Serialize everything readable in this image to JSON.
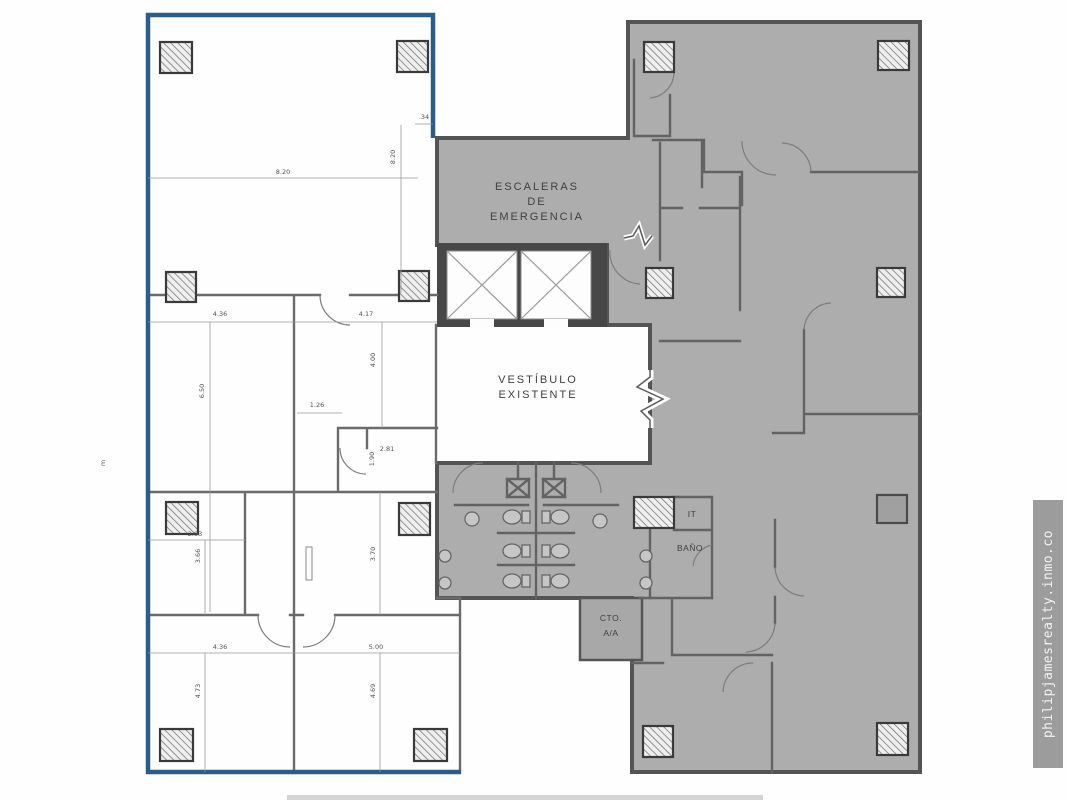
{
  "rooms": {
    "stairs": {
      "line1": "ESCALERAS",
      "line2": "DE",
      "line3": "EMERGENCIA"
    },
    "vestibule": {
      "line1": "VESTÍBULO",
      "line2": "EXISTENTE"
    },
    "it_room": "IT",
    "bathroom": "BAÑO",
    "ac_closet": {
      "line1": "CTO.",
      "line2": "A/A"
    }
  },
  "watermark": "philipjamesrealty.inmo.co",
  "colors": {
    "unit_outline": "#2a5d87",
    "building_fill": "#adadad",
    "building_stroke": "#545454",
    "wall": "#6a6a6a",
    "elevator_core": "#474747",
    "watermark_bg": "#9c9c9c"
  },
  "dimensions": [
    {
      "label": "8.20",
      "x": 283,
      "y": 174,
      "rot": 0
    },
    {
      "label": "8.20",
      "x": 395,
      "y": 157,
      "rot": -90
    },
    {
      "label": ".34",
      "x": 424,
      "y": 119,
      "rot": 0
    },
    {
      "label": "4.36",
      "x": 220,
      "y": 316,
      "rot": 0
    },
    {
      "label": "4.17",
      "x": 366,
      "y": 316,
      "rot": 0
    },
    {
      "label": "6.50",
      "x": 204,
      "y": 391,
      "rot": -90
    },
    {
      "label": "4.00",
      "x": 375,
      "y": 360,
      "rot": -90
    },
    {
      "label": "1.26",
      "x": 317,
      "y": 407,
      "rot": 0
    },
    {
      "label": "2.81",
      "x": 387,
      "y": 451,
      "rot": 0
    },
    {
      "label": "1.90",
      "x": 374,
      "y": 459,
      "rot": -90
    },
    {
      "label": "2.93",
      "x": 195,
      "y": 536,
      "rot": 0
    },
    {
      "label": "3.66",
      "x": 200,
      "y": 556,
      "rot": -90
    },
    {
      "label": "3.70",
      "x": 375,
      "y": 554,
      "rot": -90
    },
    {
      "label": "4.36",
      "x": 220,
      "y": 649,
      "rot": 0
    },
    {
      "label": "5.00",
      "x": 376,
      "y": 649,
      "rot": 0
    },
    {
      "label": "4.73",
      "x": 200,
      "y": 691,
      "rot": -90
    },
    {
      "label": "4.69",
      "x": 375,
      "y": 691,
      "rot": -90
    },
    {
      "label": "m",
      "x": 105,
      "y": 463,
      "rot": -90
    }
  ]
}
